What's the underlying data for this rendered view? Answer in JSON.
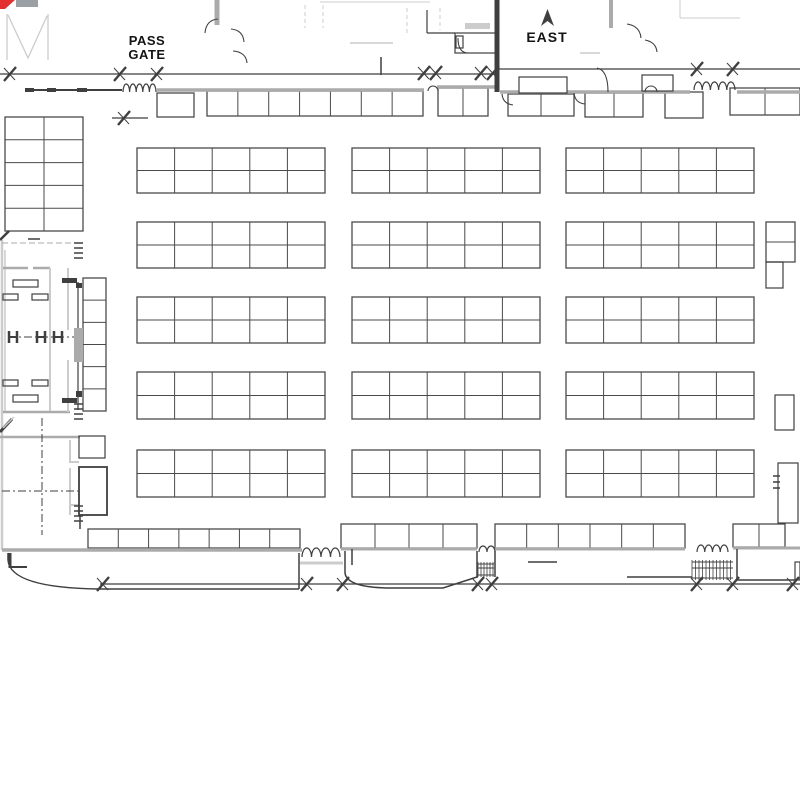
{
  "labels": {
    "pass_gate_line1": "PASS",
    "pass_gate_line2": "GATE",
    "east": "EAST"
  },
  "colors": {
    "ink": "#3f3f3f",
    "grid": "#4a4a4a",
    "wall": "#ababab",
    "light": "#cccccc",
    "graySolid": "#9aa0a3",
    "red": "#e53030",
    "white": "#ffffff"
  },
  "floorplan": {
    "grids": [
      {
        "x": 5,
        "y": 117,
        "w": 78,
        "h": 114,
        "cols": 2,
        "rows": 5
      },
      {
        "x": 137,
        "y": 148,
        "w": 188,
        "h": 45,
        "cols": 5,
        "rows": 2
      },
      {
        "x": 352,
        "y": 148,
        "w": 188,
        "h": 45,
        "cols": 5,
        "rows": 2
      },
      {
        "x": 566,
        "y": 148,
        "w": 188,
        "h": 45,
        "cols": 5,
        "rows": 2
      },
      {
        "x": 137,
        "y": 222,
        "w": 188,
        "h": 46,
        "cols": 5,
        "rows": 2
      },
      {
        "x": 352,
        "y": 222,
        "w": 188,
        "h": 46,
        "cols": 5,
        "rows": 2
      },
      {
        "x": 566,
        "y": 222,
        "w": 188,
        "h": 46,
        "cols": 5,
        "rows": 2
      },
      {
        "x": 137,
        "y": 297,
        "w": 188,
        "h": 46,
        "cols": 5,
        "rows": 2
      },
      {
        "x": 352,
        "y": 297,
        "w": 188,
        "h": 46,
        "cols": 5,
        "rows": 2
      },
      {
        "x": 566,
        "y": 297,
        "w": 188,
        "h": 46,
        "cols": 5,
        "rows": 2
      },
      {
        "x": 137,
        "y": 372,
        "w": 188,
        "h": 47,
        "cols": 5,
        "rows": 2
      },
      {
        "x": 352,
        "y": 372,
        "w": 188,
        "h": 47,
        "cols": 5,
        "rows": 2
      },
      {
        "x": 566,
        "y": 372,
        "w": 188,
        "h": 47,
        "cols": 5,
        "rows": 2
      },
      {
        "x": 137,
        "y": 450,
        "w": 188,
        "h": 47,
        "cols": 5,
        "rows": 2
      },
      {
        "x": 352,
        "y": 450,
        "w": 188,
        "h": 47,
        "cols": 5,
        "rows": 2
      },
      {
        "x": 566,
        "y": 450,
        "w": 188,
        "h": 47,
        "cols": 5,
        "rows": 2
      },
      {
        "x": 83,
        "y": 278,
        "w": 23,
        "h": 133,
        "cols": 1,
        "rows": 6
      },
      {
        "x": 766,
        "y": 222,
        "w": 29,
        "h": 40,
        "cols": 1,
        "rows": 2
      },
      {
        "x": 157,
        "y": 93,
        "w": 37,
        "h": 24,
        "cols": 1,
        "rows": 1
      },
      {
        "x": 207,
        "y": 91,
        "w": 216,
        "h": 25,
        "cols": 7,
        "rows": 1
      },
      {
        "x": 438,
        "y": 88,
        "w": 50,
        "h": 28,
        "cols": 2,
        "rows": 1
      },
      {
        "x": 508,
        "y": 94,
        "w": 66,
        "h": 22,
        "cols": 2,
        "rows": 1
      },
      {
        "x": 585,
        "y": 93,
        "w": 58,
        "h": 24,
        "cols": 2,
        "rows": 1
      },
      {
        "x": 665,
        "y": 92,
        "w": 38,
        "h": 26,
        "cols": 1,
        "rows": 1
      },
      {
        "x": 730,
        "y": 88,
        "w": 70,
        "h": 27,
        "cols": 2,
        "rows": 1
      },
      {
        "x": 88,
        "y": 529,
        "w": 212,
        "h": 19,
        "cols": 7,
        "rows": 1
      },
      {
        "x": 341,
        "y": 524,
        "w": 136,
        "h": 24,
        "cols": 4,
        "rows": 1
      },
      {
        "x": 495,
        "y": 524,
        "w": 190,
        "h": 24,
        "cols": 6,
        "rows": 1
      },
      {
        "x": 733,
        "y": 524,
        "w": 52,
        "h": 23,
        "cols": 2,
        "rows": 1
      }
    ],
    "lines": [
      {
        "p": [
          0,
          74,
          497,
          74
        ],
        "w": 1.3,
        "c": "ink"
      },
      {
        "p": [
          497,
          69,
          800,
          69
        ],
        "w": 1.3,
        "c": "ink"
      },
      {
        "p": [
          28,
          90,
          122,
          90
        ],
        "w": 2,
        "c": "ink"
      },
      {
        "p": [
          157,
          90,
          424,
          90
        ],
        "w": 3.5,
        "c": "wall"
      },
      {
        "p": [
          437,
          87,
          497,
          87
        ],
        "w": 3.5,
        "c": "wall"
      },
      {
        "p": [
          500,
          92,
          690,
          92
        ],
        "w": 3.5,
        "c": "wall"
      },
      {
        "p": [
          737,
          92,
          800,
          92
        ],
        "w": 3.5,
        "c": "wall"
      },
      {
        "p": [
          497,
          0,
          497,
          92
        ],
        "w": 5,
        "c": "ink"
      },
      {
        "p": [
          217,
          0,
          217,
          25
        ],
        "w": 5,
        "c": "wall"
      },
      {
        "p": [
          611,
          0,
          611,
          28
        ],
        "w": 4,
        "c": "wall"
      },
      {
        "p": [
          2,
          240,
          2,
          550
        ],
        "w": 2.5,
        "c": "light"
      },
      {
        "p": [
          5,
          250,
          5,
          412
        ],
        "w": 1.5,
        "c": "light"
      },
      {
        "p": [
          3,
          268,
          28,
          268
        ],
        "w": 2.5,
        "c": "wall"
      },
      {
        "p": [
          33,
          268,
          50,
          268
        ],
        "w": 2.5,
        "c": "wall"
      },
      {
        "p": [
          50,
          268,
          50,
          412
        ],
        "w": 2,
        "c": "light"
      },
      {
        "p": [
          3,
          412,
          70,
          412
        ],
        "w": 2.5,
        "c": "wall"
      },
      {
        "p": [
          68,
          268,
          68,
          330
        ],
        "w": 2,
        "c": "light"
      },
      {
        "p": [
          68,
          360,
          68,
          412
        ],
        "w": 2,
        "c": "light"
      },
      {
        "p": [
          78,
          282,
          78,
          410
        ],
        "w": 1.2,
        "c": "ink"
      },
      {
        "p": [
          0,
          437,
          80,
          437
        ],
        "w": 2.5,
        "c": "wall"
      },
      {
        "p": [
          70,
          440,
          70,
          463
        ],
        "w": 2,
        "c": "light"
      },
      {
        "p": [
          70,
          468,
          70,
          515
        ],
        "w": 2,
        "c": "light"
      },
      {
        "p": [
          70,
          462,
          79,
          462
        ],
        "w": 2,
        "c": "light"
      },
      {
        "p": [
          70,
          505,
          79,
          505
        ],
        "w": 2,
        "c": "light"
      },
      {
        "p": [
          80,
          515,
          80,
          529
        ],
        "w": 1.5,
        "c": "ink"
      },
      {
        "p": [
          2,
          550,
          302,
          550
        ],
        "w": 3.5,
        "c": "wall"
      },
      {
        "p": [
          341,
          549,
          477,
          549
        ],
        "w": 3,
        "c": "wall"
      },
      {
        "p": [
          495,
          549,
          685,
          549
        ],
        "w": 3,
        "c": "wall"
      },
      {
        "p": [
          733,
          548,
          800,
          548
        ],
        "w": 3,
        "c": "wall"
      },
      {
        "p": [
          300,
          563,
          343,
          563
        ],
        "w": 3,
        "c": "light"
      },
      {
        "p": [
          100,
          584,
          800,
          584
        ],
        "w": 1.2,
        "c": "ink"
      },
      {
        "p": [
          112,
          118,
          148,
          118
        ],
        "w": 1.2,
        "c": "ink"
      },
      {
        "p": [
          528,
          562,
          557,
          562
        ],
        "w": 1.5,
        "c": "ink"
      },
      {
        "p": [
          627,
          577,
          692,
          577
        ],
        "w": 1.5,
        "c": "ink"
      },
      {
        "p": [
          737,
          549,
          737,
          580
        ],
        "w": 1.5,
        "c": "ink"
      },
      {
        "p": [
          737,
          580,
          795,
          580
        ],
        "w": 1.5,
        "c": "ink"
      },
      {
        "p": [
          345,
          551,
          345,
          573
        ],
        "w": 1.5,
        "c": "ink"
      },
      {
        "p": [
          477,
          551,
          477,
          578
        ],
        "w": 1.5,
        "c": "ink"
      },
      {
        "p": [
          495,
          551,
          495,
          577
        ],
        "w": 1.5,
        "c": "ink"
      },
      {
        "p": [
          299,
          553,
          299,
          589
        ],
        "w": 1.5,
        "c": "ink"
      },
      {
        "p": [
          352,
          549,
          352,
          565
        ],
        "w": 1.5,
        "c": "ink"
      },
      {
        "p": [
          320,
          2,
          430,
          2
        ],
        "w": 1,
        "c": "light"
      },
      {
        "p": [
          350,
          43,
          393,
          43
        ],
        "w": 1.5,
        "c": "light"
      },
      {
        "p": [
          305,
          5,
          305,
          28
        ],
        "w": 1,
        "c": "light",
        "d": "4 3"
      },
      {
        "p": [
          323,
          5,
          323,
          28
        ],
        "w": 1,
        "c": "light",
        "d": "4 3"
      },
      {
        "p": [
          407,
          8,
          407,
          35
        ],
        "w": 1,
        "c": "light",
        "d": "4 3"
      },
      {
        "p": [
          440,
          8,
          440,
          30
        ],
        "w": 1,
        "c": "light",
        "d": "4 3"
      },
      {
        "p": [
          427,
          10,
          427,
          33
        ],
        "w": 1.2,
        "c": "ink"
      },
      {
        "p": [
          427,
          33,
          455,
          33
        ],
        "w": 1.2,
        "c": "ink"
      },
      {
        "p": [
          680,
          0,
          680,
          18
        ],
        "w": 1,
        "c": "light"
      },
      {
        "p": [
          680,
          18,
          740,
          18
        ],
        "w": 1,
        "c": "light"
      },
      {
        "p": [
          580,
          53,
          600,
          53
        ],
        "w": 1.5,
        "c": "light"
      },
      {
        "p": [
          2,
          243,
          80,
          243
        ],
        "w": 1,
        "c": "wall",
        "d": "6 3"
      },
      {
        "p": [
          8,
          337,
          78,
          337
        ],
        "w": 1,
        "c": "ink",
        "d": "8 3 2 3"
      },
      {
        "p": [
          42,
          418,
          42,
          535
        ],
        "w": 1,
        "c": "ink",
        "d": "8 3 2 3"
      },
      {
        "p": [
          2,
          491,
          78,
          491
        ],
        "w": 1,
        "c": "ink",
        "d": "8 3 2 3"
      },
      {
        "p": [
          10,
          553,
          10,
          568
        ],
        "w": 3,
        "c": "ink"
      },
      {
        "p": [
          10,
          567,
          27,
          567
        ],
        "w": 2,
        "c": "ink"
      },
      {
        "p": [
          0,
          240,
          9,
          231
        ],
        "w": 2.5,
        "c": "ink"
      },
      {
        "p": [
          0,
          432,
          12,
          419
        ],
        "w": 3,
        "c": "ink"
      },
      {
        "p": [
          3,
          428,
          14,
          417
        ],
        "w": 1.5,
        "c": "light"
      },
      {
        "p": [
          381,
          57,
          381,
          75
        ],
        "w": 1.5,
        "c": "ink"
      },
      {
        "p": [
          28,
          239,
          40,
          239
        ],
        "w": 1.5,
        "c": "ink"
      }
    ],
    "paths": [
      {
        "d": "M8,553 L8,560 Q10,588 100,589 L299,589",
        "w": 1.5,
        "c": "ink"
      },
      {
        "d": "M345,573 Q347,588 392,588 L443,588 L477,577",
        "w": 1.5,
        "c": "ink"
      },
      {
        "d": "M7,14 L7,60 M8,15 L28,58 L47,16 M48,14 L48,60",
        "w": 1.3,
        "c": "light"
      }
    ],
    "arcs": [
      {
        "d": "M205,33 Q206,20 218,19"
      },
      {
        "d": "M231,29 Q243,30 244,42"
      },
      {
        "d": "M233,51 Q246,52 247,63"
      },
      {
        "d": "M458,38 Q458,52 467,53"
      },
      {
        "d": "M502,94 Q503,104 513,105"
      },
      {
        "d": "M574,93 Q575,103 585,104"
      },
      {
        "d": "M597,68 Q608,70 608,92"
      },
      {
        "d": "M627,24 Q640,26 641,38"
      },
      {
        "d": "M645,40 Q656,42 657,52"
      },
      {
        "d": "M645,92 A6,6 0 0 1 657,92"
      },
      {
        "d": "M428,91 A5,5 0 0 1 438,91"
      }
    ],
    "frects": [
      {
        "x": 74,
        "y": 328,
        "w": 9,
        "h": 34,
        "f": "wall"
      },
      {
        "x": 76,
        "y": 283,
        "w": 6,
        "h": 5,
        "f": "ink"
      },
      {
        "x": 76,
        "y": 391,
        "w": 6,
        "h": 6,
        "f": "ink"
      },
      {
        "x": 62,
        "y": 278,
        "w": 15,
        "h": 5,
        "f": "ink"
      },
      {
        "x": 62,
        "y": 398,
        "w": 15,
        "h": 5,
        "f": "ink"
      },
      {
        "x": 16,
        "y": 0,
        "w": 22,
        "h": 7,
        "f": "graySolid"
      },
      {
        "x": 465,
        "y": 23,
        "w": 25,
        "h": 6,
        "f": "light"
      },
      {
        "x": 25,
        "y": 88,
        "w": 9,
        "h": 4,
        "f": "ink"
      },
      {
        "x": 47,
        "y": 88,
        "w": 9,
        "h": 4,
        "f": "ink"
      },
      {
        "x": 77,
        "y": 88,
        "w": 10,
        "h": 4,
        "f": "ink"
      }
    ],
    "rects": [
      {
        "x": 519,
        "y": 77,
        "w": 48,
        "h": 16,
        "f": "white"
      },
      {
        "x": 642,
        "y": 75,
        "w": 31,
        "h": 16,
        "f": "white"
      },
      {
        "x": 766,
        "y": 262,
        "w": 17,
        "h": 26
      },
      {
        "x": 775,
        "y": 395,
        "w": 19,
        "h": 35
      },
      {
        "x": 778,
        "y": 463,
        "w": 20,
        "h": 60,
        "f": "white"
      },
      {
        "x": 79,
        "y": 436,
        "w": 26,
        "h": 22
      },
      {
        "x": 79,
        "y": 467,
        "w": 28,
        "h": 48,
        "th": 1.8
      },
      {
        "x": 455,
        "y": 33,
        "w": 42,
        "h": 20
      },
      {
        "x": 456,
        "y": 36,
        "w": 7,
        "h": 12
      },
      {
        "x": 795,
        "y": 562,
        "w": 5,
        "h": 18
      },
      {
        "x": 13,
        "y": 280,
        "w": 25,
        "h": 7
      },
      {
        "x": 13,
        "y": 395,
        "w": 25,
        "h": 7
      },
      {
        "x": 3,
        "y": 294,
        "w": 15,
        "h": 6
      },
      {
        "x": 32,
        "y": 294,
        "w": 16,
        "h": 6
      },
      {
        "x": 3,
        "y": 380,
        "w": 15,
        "h": 6
      },
      {
        "x": 32,
        "y": 380,
        "w": 16,
        "h": 6
      }
    ],
    "springs": [
      {
        "x": 123,
        "y": 92,
        "w": 33,
        "n": 5,
        "h": 8
      },
      {
        "x": 694,
        "y": 90,
        "w": 41,
        "n": 5,
        "h": 8
      },
      {
        "x": 302,
        "y": 557,
        "w": 38,
        "n": 4,
        "h": 9
      },
      {
        "x": 479,
        "y": 552,
        "w": 16,
        "n": 2,
        "h": 6
      },
      {
        "x": 697,
        "y": 552,
        "w": 31,
        "n": 4,
        "h": 7
      }
    ],
    "hatches": [
      {
        "x": 478,
        "y": 562,
        "w": 16,
        "h": 15,
        "s": 3
      },
      {
        "x": 692,
        "y": 560,
        "w": 41,
        "h": 20,
        "s": 3.5
      }
    ],
    "ticks": [
      {
        "x": 10,
        "y": 74
      },
      {
        "x": 120,
        "y": 74
      },
      {
        "x": 157,
        "y": 74
      },
      {
        "x": 424,
        "y": 73
      },
      {
        "x": 436,
        "y": 73
      },
      {
        "x": 481,
        "y": 73
      },
      {
        "x": 493,
        "y": 73
      },
      {
        "x": 697,
        "y": 69
      },
      {
        "x": 733,
        "y": 69
      },
      {
        "x": 124,
        "y": 118
      },
      {
        "x": 103,
        "y": 584
      },
      {
        "x": 307,
        "y": 584
      },
      {
        "x": 343,
        "y": 584
      },
      {
        "x": 478,
        "y": 584
      },
      {
        "x": 492,
        "y": 584
      },
      {
        "x": 697,
        "y": 584
      },
      {
        "x": 733,
        "y": 584
      },
      {
        "x": 793,
        "y": 584
      }
    ],
    "beams": [
      {
        "x": 13,
        "y": 337
      },
      {
        "x": 41,
        "y": 337
      },
      {
        "x": 58,
        "y": 337
      }
    ],
    "dash_stacks": [
      {
        "x": 74,
        "y": 243,
        "w": 9,
        "n": 4,
        "g": 5
      },
      {
        "x": 74,
        "y": 404,
        "w": 9,
        "n": 4,
        "g": 5
      },
      {
        "x": 74,
        "y": 506,
        "w": 9,
        "n": 4,
        "g": 5
      },
      {
        "x": 773,
        "y": 476,
        "w": 7,
        "n": 3,
        "g": 6
      }
    ],
    "polys": [
      {
        "pts": "0,0 15,0 5,9 0,9",
        "f": "red",
        "name": "logo-fragment-red"
      },
      {
        "pts": "547.5,9 554,26 547.5,21 541,26",
        "f": "ink",
        "name": "east-direction-arrow-icon"
      }
    ]
  }
}
